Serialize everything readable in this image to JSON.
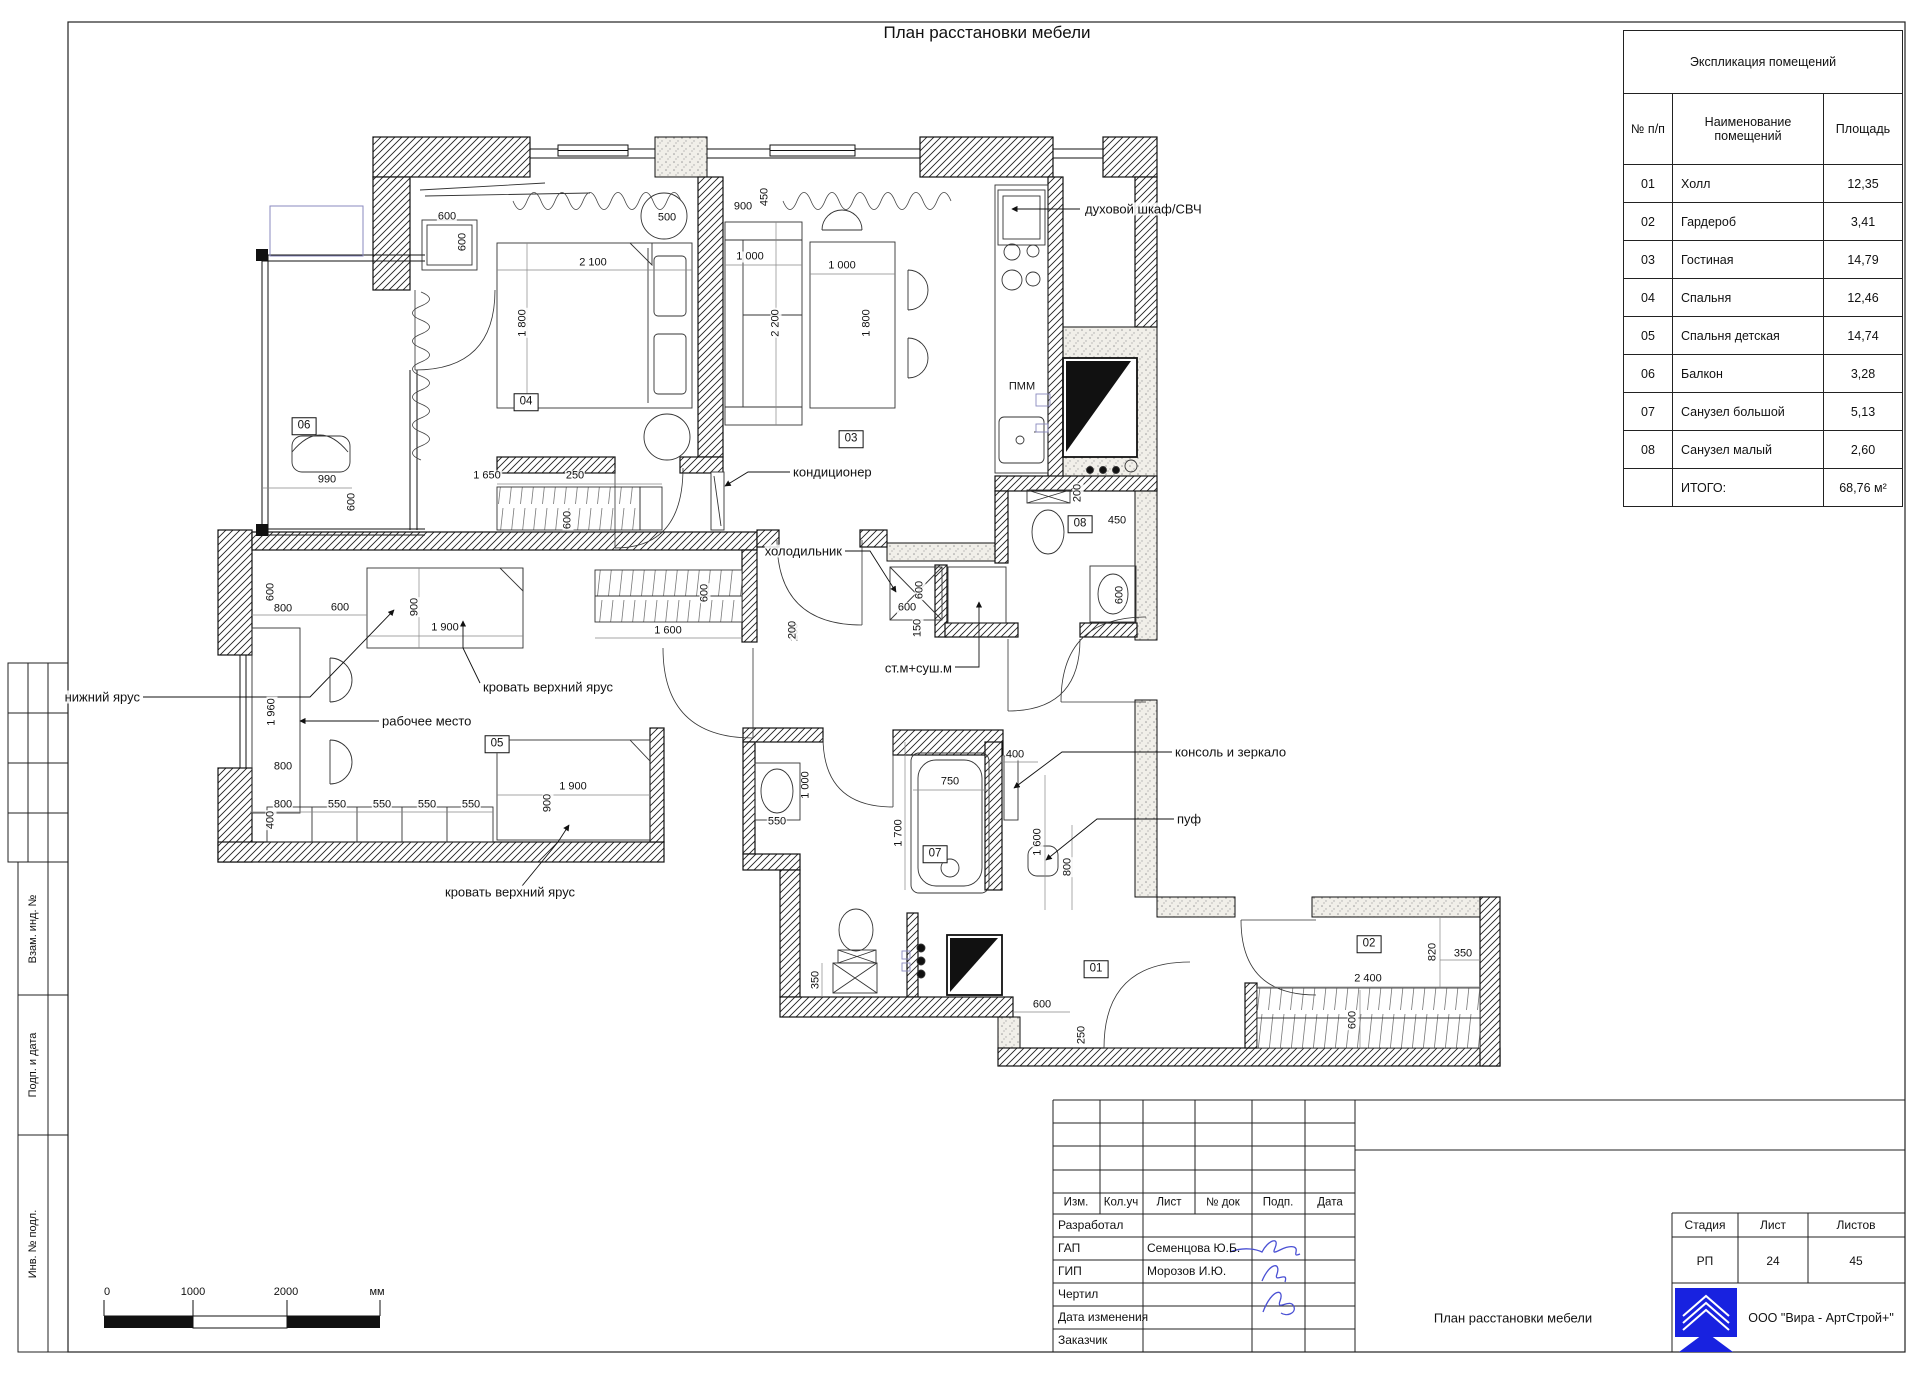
{
  "page": {
    "title": "План расстановки мебели"
  },
  "explication": {
    "title": "Экспликация помещений",
    "col_num": "№ п/п",
    "col_name": "Наименование помещений",
    "col_area": "Площадь",
    "rows": [
      {
        "num": "01",
        "name": "Холл",
        "area": "12,35"
      },
      {
        "num": "02",
        "name": "Гардероб",
        "area": "3,41"
      },
      {
        "num": "03",
        "name": "Гостиная",
        "area": "14,79"
      },
      {
        "num": "04",
        "name": "Спальня",
        "area": "12,46"
      },
      {
        "num": "05",
        "name": "Спальня детская",
        "area": "14,74"
      },
      {
        "num": "06",
        "name": "Балкон",
        "area": "3,28"
      },
      {
        "num": "07",
        "name": "Санузел большой",
        "area": "5,13"
      },
      {
        "num": "08",
        "name": "Санузел малый",
        "area": "2,60"
      },
      {
        "num": "",
        "name": "ИТОГО:",
        "area": "68,76 м²"
      }
    ]
  },
  "plan": {
    "room_tags": [
      {
        "t": "06",
        "x": 304,
        "y": 426
      },
      {
        "t": "04",
        "x": 526,
        "y": 402
      },
      {
        "t": "03",
        "x": 851,
        "y": 439
      },
      {
        "t": "08",
        "x": 1080,
        "y": 524
      },
      {
        "t": "05",
        "x": 497,
        "y": 744
      },
      {
        "t": "07",
        "x": 935,
        "y": 854
      },
      {
        "t": "01",
        "x": 1096,
        "y": 969
      },
      {
        "t": "02",
        "x": 1369,
        "y": 944
      }
    ],
    "dimensions": [
      {
        "t": "600",
        "x": 447,
        "y": 217
      },
      {
        "t": "600",
        "x": 463,
        "y": 242,
        "v": 1
      },
      {
        "t": "2 100",
        "x": 593,
        "y": 263
      },
      {
        "t": "500",
        "x": 667,
        "y": 218
      },
      {
        "t": "1 800",
        "x": 523,
        "y": 323,
        "v": 1
      },
      {
        "t": "990",
        "x": 327,
        "y": 480
      },
      {
        "t": "600",
        "x": 352,
        "y": 502,
        "v": 1
      },
      {
        "t": "1 650",
        "x": 487,
        "y": 476
      },
      {
        "t": "250",
        "x": 575,
        "y": 476
      },
      {
        "t": "600",
        "x": 568,
        "y": 520,
        "v": 1
      },
      {
        "t": "900",
        "x": 743,
        "y": 207
      },
      {
        "t": "450",
        "x": 765,
        "y": 197,
        "v": 1
      },
      {
        "t": "1 000",
        "x": 750,
        "y": 257
      },
      {
        "t": "1 000",
        "x": 842,
        "y": 266
      },
      {
        "t": "2 200",
        "x": 776,
        "y": 323,
        "v": 1
      },
      {
        "t": "1 800",
        "x": 867,
        "y": 323,
        "v": 1
      },
      {
        "t": "ПММ",
        "x": 1022,
        "y": 387
      },
      {
        "t": "200",
        "x": 1078,
        "y": 493,
        "v": 1
      },
      {
        "t": "450",
        "x": 1117,
        "y": 521
      },
      {
        "t": "600",
        "x": 1120,
        "y": 595,
        "v": 1
      },
      {
        "t": "600",
        "x": 920,
        "y": 590,
        "v": 1
      },
      {
        "t": "600",
        "x": 907,
        "y": 608
      },
      {
        "t": "150",
        "x": 918,
        "y": 628,
        "v": 1
      },
      {
        "t": "200",
        "x": 795,
        "y": 632,
        "v": 1
      },
      {
        "t": "600",
        "x": 271,
        "y": 592,
        "v": 1
      },
      {
        "t": "800",
        "x": 283,
        "y": 609
      },
      {
        "t": "600",
        "x": 340,
        "y": 608
      },
      {
        "t": "900",
        "x": 415,
        "y": 607,
        "v": 1
      },
      {
        "t": "1 900",
        "x": 445,
        "y": 628
      },
      {
        "t": "1 960",
        "x": 272,
        "y": 712,
        "v": 1
      },
      {
        "t": "800",
        "x": 283,
        "y": 767
      },
      {
        "t": "800",
        "x": 283,
        "y": 805
      },
      {
        "t": "550",
        "x": 337,
        "y": 805
      },
      {
        "t": "550",
        "x": 382,
        "y": 805
      },
      {
        "t": "550",
        "x": 427,
        "y": 805
      },
      {
        "t": "550",
        "x": 471,
        "y": 805
      },
      {
        "t": "400",
        "x": 271,
        "y": 820,
        "v": 1
      },
      {
        "t": "900",
        "x": 548,
        "y": 803,
        "v": 1
      },
      {
        "t": "1 900",
        "x": 573,
        "y": 787
      },
      {
        "t": "600",
        "x": 705,
        "y": 593,
        "v": 1
      },
      {
        "t": "1 600",
        "x": 668,
        "y": 631
      },
      {
        "t": "200",
        "x": 793,
        "y": 630,
        "v": 1
      },
      {
        "t": "550",
        "x": 777,
        "y": 822
      },
      {
        "t": "1 000",
        "x": 806,
        "y": 785,
        "v": 1
      },
      {
        "t": "750",
        "x": 950,
        "y": 782
      },
      {
        "t": "1 700",
        "x": 899,
        "y": 833,
        "v": 1
      },
      {
        "t": "400",
        "x": 1015,
        "y": 755
      },
      {
        "t": "1 600",
        "x": 1038,
        "y": 842,
        "v": 1
      },
      {
        "t": "800",
        "x": 1068,
        "y": 867,
        "v": 1
      },
      {
        "t": "350",
        "x": 816,
        "y": 980,
        "v": 1
      },
      {
        "t": "600",
        "x": 1042,
        "y": 1005
      },
      {
        "t": "250",
        "x": 1082,
        "y": 1035,
        "v": 1
      },
      {
        "t": "820",
        "x": 1433,
        "y": 952,
        "v": 1
      },
      {
        "t": "350",
        "x": 1463,
        "y": 954
      },
      {
        "t": "2 400",
        "x": 1368,
        "y": 979
      },
      {
        "t": "600",
        "x": 1353,
        "y": 1020,
        "v": 1
      }
    ],
    "callouts": [
      {
        "t": "духовой шкаф/СВЧ",
        "x": 1085,
        "y": 209,
        "a": "l"
      },
      {
        "t": "кондиционер",
        "x": 793,
        "y": 472,
        "a": "l"
      },
      {
        "t": "холодильник",
        "x": 842,
        "y": 551,
        "a": "r"
      },
      {
        "t": "ст.м+суш.м",
        "x": 952,
        "y": 668,
        "a": "r"
      },
      {
        "t": "консоль и зеркало",
        "x": 1175,
        "y": 752,
        "a": "l"
      },
      {
        "t": "пуф",
        "x": 1177,
        "y": 819,
        "a": "l"
      },
      {
        "t": "нижний ярус",
        "x": 140,
        "y": 697,
        "a": "r"
      },
      {
        "t": "рабочее место",
        "x": 382,
        "y": 721,
        "a": "l"
      },
      {
        "t": "кровать верхний ярус",
        "x": 483,
        "y": 687,
        "a": "l"
      },
      {
        "t": "кровать верхний ярус",
        "x": 445,
        "y": 892,
        "a": "l"
      }
    ]
  },
  "scalebar": {
    "t0": "0",
    "t1": "1000",
    "t2": "2000",
    "unit": "мм"
  },
  "sidebar": {
    "labels": [
      "Взам. инд. №",
      "Подп. и дата",
      "Инв. № подл."
    ]
  },
  "titleblock": {
    "cols": [
      "Изм.",
      "Кол.уч",
      "Лист",
      "№ док",
      "Подп.",
      "Дата"
    ],
    "rows": [
      {
        "label": "Разработал",
        "value": ""
      },
      {
        "label": "ГАП",
        "value": "Семенцова Ю.Б."
      },
      {
        "label": "ГИП",
        "value": "Морозов И.Ю."
      },
      {
        "label": "Чертил",
        "value": ""
      },
      {
        "label": "Дата изменения",
        "value": ""
      },
      {
        "label": "Заказчик",
        "value": ""
      }
    ],
    "stage_label": "Стадия",
    "sheet_label": "Лист",
    "sheets_label": "Листов",
    "stage": "РП",
    "sheet": "24",
    "sheets": "45",
    "doc_title": "План расстановки мебели",
    "company": "ООО \"Вира - АртСтрой+\""
  }
}
